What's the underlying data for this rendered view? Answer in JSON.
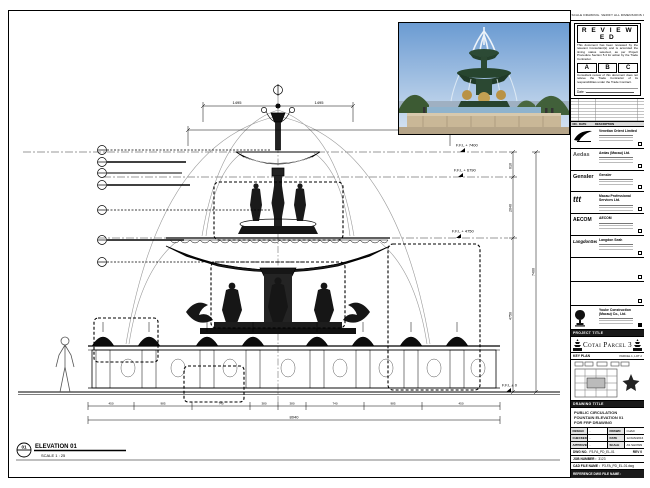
{
  "stamp": {
    "strip_text": "DO NOT SCALE DRAWING. VERIFY ALL DIMENSIONS ON SITE.",
    "title": "R E V I E W E D",
    "para1": "This document has been reviewed by the relevant Consultant(s) and is accorded the timing status selected, as per Project Procedure Section 5.4 for action by the Trade Contractor.",
    "grades": [
      "A",
      "B",
      "C"
    ],
    "para2": "Consultant review of this document does not relieve the Trade Contractor of its responsibilities under the Trade Contract.",
    "date_label": "Date :"
  },
  "revision_table": {
    "no": "NO.",
    "date": "DATE",
    "desc": "DESCRIPTION"
  },
  "consultants": [
    {
      "logo_text": "",
      "name": "Venetian Orient Limited"
    },
    {
      "logo_text": "Aedas",
      "name": "Aedas (Macau) Ltd."
    },
    {
      "logo_text": "Gensler",
      "name": "Gensler"
    },
    {
      "logo_text": "ttt",
      "name": "Macau Professional Services Ltd."
    },
    {
      "logo_text": "AECOM",
      "name": "AECOM"
    },
    {
      "logo_text": "LangdonSeah",
      "name": "Langdon Seah"
    }
  ],
  "contractor": {
    "name": "Youke Construction (Macau) Co., Ltd."
  },
  "project": {
    "band_label": "PROJECT TITLE",
    "title": "Cotai Parcel 3"
  },
  "key_plan": {
    "label": "KEY PLAN",
    "note": "PARCEL 1, LOT 2"
  },
  "drawing_title": {
    "band_label": "DRAWING TITLE",
    "line1": "PUBLIC CIRCULATION",
    "line2": "FOUNTAIN ELEVATION 01",
    "line3": "FOR FRP DRAWING"
  },
  "info_table": {
    "design_label": "DESIGN",
    "design": "-",
    "drawn_label": "DRAWN",
    "drawn": "CHAD",
    "checked_label": "CHECKED",
    "checked": "-",
    "date_label": "DATE",
    "date": "12/JAN/2016",
    "approved_label": "APPROVED",
    "approved": "-",
    "scale_label": "SCALE",
    "scale": "AS SHOWN",
    "dwg_no_label": "DWG NO.",
    "dwg_no": "P3-FA_PD_EL-01",
    "rev": "REV 0",
    "job_label": "JOB NUMBER :",
    "job": "3123",
    "cad_label": "CAD FILE NAME :",
    "cad": "P3-FA_PD_EL-01.dwg",
    "ref_label": "REFERENCE DWG FILE NAME :"
  },
  "elevation_view": {
    "tag_number": "01",
    "tag_title": "ELEVATION 01",
    "tag_scale": "SCALE 1 : 25",
    "levels": [
      "F.F.L + 7400",
      "F.F.L + 6790",
      "F.F.L + 4750",
      "F.F.L ± 0"
    ],
    "vdims": [
      "610",
      "2040",
      "4750",
      "7400"
    ],
    "top_dims": [
      "1495",
      "1495"
    ],
    "bottom_dims": [
      "450",
      "985",
      "740",
      "380",
      "380",
      "740",
      "985",
      "450"
    ],
    "overall_dim": "8040"
  },
  "colors": {
    "line": "#000000",
    "water_arc": "#9a9a9a",
    "photo_sky": "#6b9bd2",
    "photo_bronze_green": "#2c4a35",
    "photo_gold": "#b99245",
    "photo_stone": "#c9b797"
  }
}
